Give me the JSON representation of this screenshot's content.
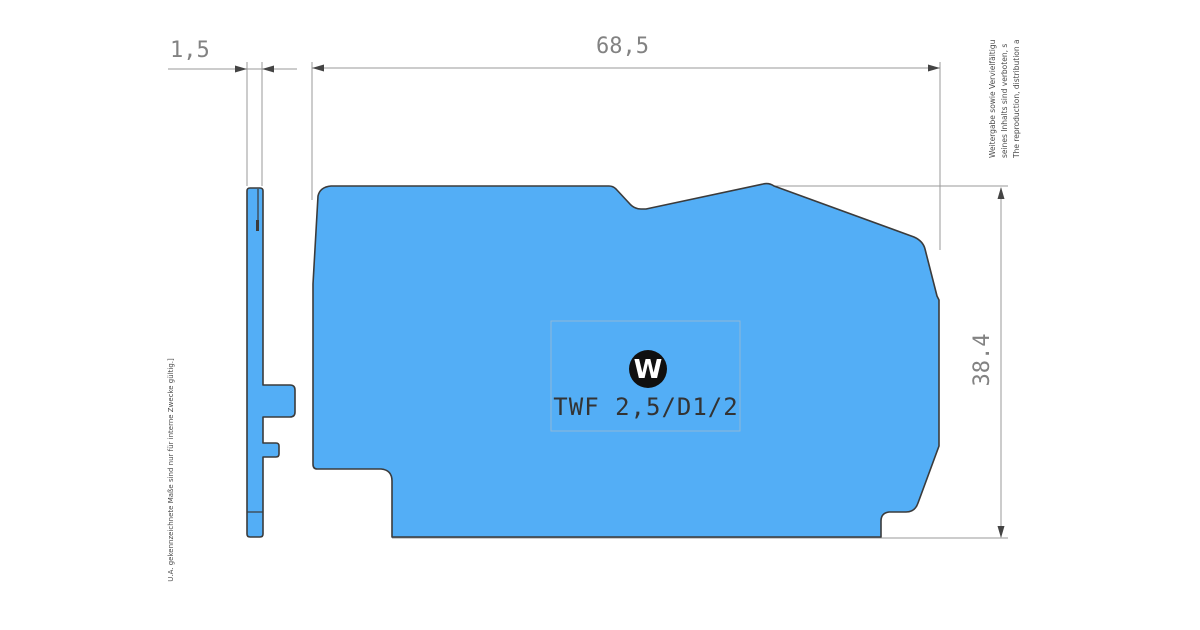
{
  "drawing": {
    "part_label": "TWF 2,5/D1/2",
    "logo_letter": "W",
    "dimensions": {
      "side_thickness": "1,5",
      "body_length": "68,5",
      "body_height": "38.4"
    },
    "notes": {
      "right_line1": "Weitergabe sowie Vervielfältigu",
      "right_line2": "seines Inhalts sind verboten, s",
      "right_line3": "The reproduction, distribution a",
      "left_line": "U.A. gekennzeichnete Maße sind nur für interne Zwecke gültig.]"
    }
  },
  "colors": {
    "part_fill": "#53aef6",
    "part_outline": "#3b3b3b",
    "dimension_line": "#9a9a9a",
    "dimension_text": "#828282",
    "arrow": "#444444",
    "label_frame": "#8fb8d8",
    "logo": "#101010",
    "part_text": "#333333",
    "note_text": "#4a4a4a"
  }
}
